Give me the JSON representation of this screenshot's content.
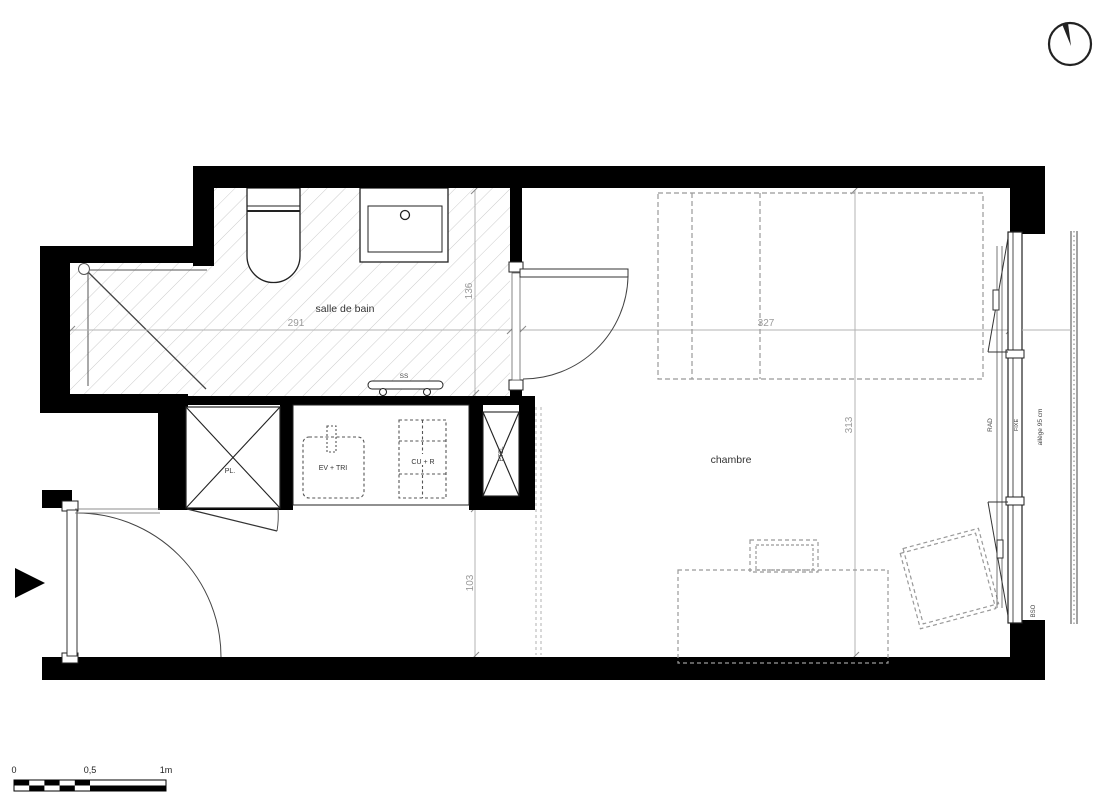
{
  "rooms": {
    "bathroom": "salle de bain",
    "bedroom": "chambre"
  },
  "dimensions": {
    "bathroom_width": "291",
    "bathroom_depth": "136",
    "bedroom_width": "327",
    "bedroom_depth": "313",
    "entry_width": "103"
  },
  "fixtures": {
    "towel_rail": "SS",
    "sink_unit": "EV + TRI",
    "cooking_fridge": "CU + R",
    "closet": "PL.",
    "duct": "ETEL"
  },
  "window": {
    "radiator": "RAD",
    "fixed_pane": "FIXE",
    "sill_height": "allège 95 cm",
    "blinds": "BSO"
  },
  "scale_bar": {
    "zero": "0",
    "half": "0,5",
    "one_meter": "1m"
  }
}
